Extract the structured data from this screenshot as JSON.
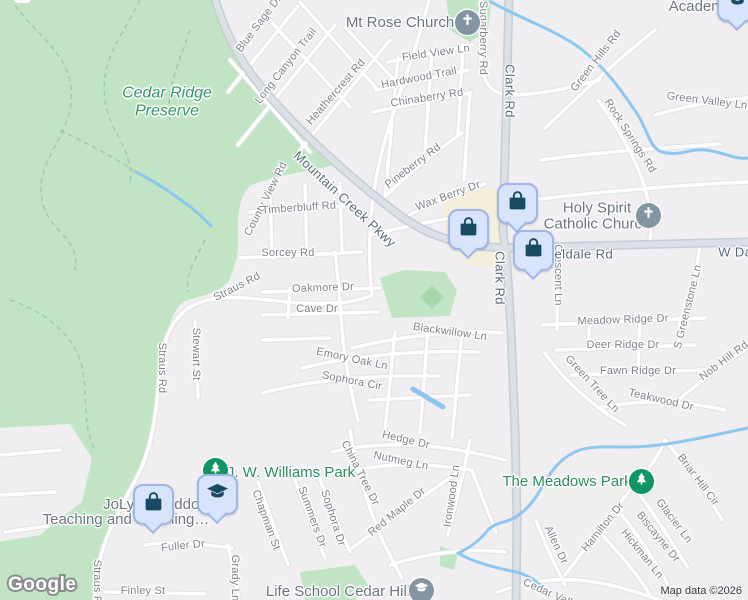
{
  "attribution": {
    "logo_text": "Google",
    "map_data_text": "Map data ©2026"
  },
  "colors": {
    "background": "#f0eef1",
    "park_green": "#c1e5c4",
    "field_green": "#a6d7a8",
    "water_blue": "#8cc7f0",
    "commercial_beige": "#f4eeda",
    "road_minor_fill": "#ffffff",
    "road_minor_casing": "#e3e0e4",
    "road_major_fill": "#dbe0e7",
    "road_major_casing": "#c6ccd4",
    "pin_blue_bg": "#d7e4fb",
    "pin_glyph_navy": "#174b63",
    "poi_pin_gray": "#8494a3",
    "park_pin_green": "#0f9463",
    "street_label": "#7e8389",
    "major_road_label": "#586a78",
    "poi_label": "#6c757d",
    "park_label": "#2d8c5f"
  },
  "map": {
    "labels": [
      {
        "text": "Blue Sage Dr",
        "x": 259,
        "y": 24,
        "rot": -53,
        "kind": "street"
      },
      {
        "text": "Long Canyon Trail",
        "x": 286,
        "y": 66,
        "rot": -52,
        "kind": "street"
      },
      {
        "text": "Heathercrest Rd",
        "x": 336,
        "y": 92,
        "rot": -49,
        "kind": "street"
      },
      {
        "text": "Sugarberry Rd",
        "x": 483,
        "y": 38,
        "rot": 90,
        "kind": "street"
      },
      {
        "text": "Field View Ln",
        "x": 436,
        "y": 53,
        "rot": -8,
        "kind": "street"
      },
      {
        "text": "Hardwood Trail",
        "x": 419,
        "y": 78,
        "rot": -11,
        "kind": "street"
      },
      {
        "text": "Chinaberry Rd",
        "x": 427,
        "y": 98,
        "rot": -9,
        "kind": "street"
      },
      {
        "text": "Green Hills Rd",
        "x": 596,
        "y": 61,
        "rot": -52,
        "kind": "street"
      },
      {
        "text": "Green Valley Ln",
        "x": 707,
        "y": 101,
        "rot": 7,
        "kind": "street"
      },
      {
        "text": "Rock Springs Rd",
        "x": 630,
        "y": 136,
        "rot": 57,
        "kind": "street"
      },
      {
        "text": "Pineberry Rd",
        "x": 413,
        "y": 166,
        "rot": -37,
        "kind": "street"
      },
      {
        "text": "Wax Berry Dr",
        "x": 448,
        "y": 196,
        "rot": -20,
        "kind": "street"
      },
      {
        "text": "County View Rd",
        "x": 266,
        "y": 199,
        "rot": -63,
        "kind": "street"
      },
      {
        "text": "Timberbluff Rd",
        "x": 299,
        "y": 208,
        "rot": -4,
        "kind": "street"
      },
      {
        "text": "Sorcey Rd",
        "x": 288,
        "y": 253,
        "rot": 0,
        "kind": "street"
      },
      {
        "text": "Straus Rd",
        "x": 237,
        "y": 287,
        "rot": -27,
        "kind": "street"
      },
      {
        "text": "Oakmore Dr",
        "x": 323,
        "y": 288,
        "rot": -2,
        "kind": "street"
      },
      {
        "text": "Cave Dr",
        "x": 317,
        "y": 309,
        "rot": 0,
        "kind": "street"
      },
      {
        "text": "Crescent Ln",
        "x": 558,
        "y": 275,
        "rot": 90,
        "kind": "street"
      },
      {
        "text": "Blackwillow Ln",
        "x": 450,
        "y": 332,
        "rot": 8,
        "kind": "street"
      },
      {
        "text": "Meadow Ridge Dr",
        "x": 623,
        "y": 320,
        "rot": -2,
        "kind": "street"
      },
      {
        "text": "Deer Ridge Dr",
        "x": 623,
        "y": 345,
        "rot": 0,
        "kind": "street"
      },
      {
        "text": "S Greenstone Ln",
        "x": 688,
        "y": 307,
        "rot": -76,
        "kind": "street"
      },
      {
        "text": "Straus Rd",
        "x": 162,
        "y": 368,
        "rot": 90,
        "kind": "street"
      },
      {
        "text": "Stewart St",
        "x": 196,
        "y": 354,
        "rot": 90,
        "kind": "street"
      },
      {
        "text": "Fawn Ridge Dr",
        "x": 638,
        "y": 371,
        "rot": 0,
        "kind": "street"
      },
      {
        "text": "Emory Oak Ln",
        "x": 352,
        "y": 359,
        "rot": 12,
        "kind": "street"
      },
      {
        "text": "Green Tree Ln",
        "x": 592,
        "y": 384,
        "rot": 47,
        "kind": "street"
      },
      {
        "text": "Sophora Cir",
        "x": 352,
        "y": 381,
        "rot": 11,
        "kind": "street"
      },
      {
        "text": "Teakwood Dr",
        "x": 661,
        "y": 400,
        "rot": 13,
        "kind": "street"
      },
      {
        "text": "Nob Hill Rd",
        "x": 724,
        "y": 361,
        "rot": -37,
        "kind": "street"
      },
      {
        "text": "Hedge Dr",
        "x": 406,
        "y": 440,
        "rot": 13,
        "kind": "street"
      },
      {
        "text": "Nutmeg Ln",
        "x": 401,
        "y": 461,
        "rot": 12,
        "kind": "street"
      },
      {
        "text": "China Tree Dr",
        "x": 360,
        "y": 473,
        "rot": 63,
        "kind": "street"
      },
      {
        "text": "Ironwood Ln",
        "x": 452,
        "y": 496,
        "rot": -82,
        "kind": "street"
      },
      {
        "text": "Red Maple Dr",
        "x": 397,
        "y": 512,
        "rot": -39,
        "kind": "street"
      },
      {
        "text": "Briar Hill Cir",
        "x": 698,
        "y": 480,
        "rot": 53,
        "kind": "street"
      },
      {
        "text": "Chapman St",
        "x": 266,
        "y": 520,
        "rot": 70,
        "kind": "street"
      },
      {
        "text": "Summers Dr",
        "x": 312,
        "y": 517,
        "rot": 70,
        "kind": "street"
      },
      {
        "text": "Sophora Dr",
        "x": 333,
        "y": 518,
        "rot": 72,
        "kind": "street"
      },
      {
        "text": "Hamilton Dr",
        "x": 603,
        "y": 527,
        "rot": -51,
        "kind": "street"
      },
      {
        "text": "Glacier Ln",
        "x": 674,
        "y": 521,
        "rot": 53,
        "kind": "street"
      },
      {
        "text": "Biscayne Dr",
        "x": 658,
        "y": 537,
        "rot": 51,
        "kind": "street"
      },
      {
        "text": "Allen Dr",
        "x": 556,
        "y": 545,
        "rot": 65,
        "kind": "street"
      },
      {
        "text": "Hickman Ln",
        "x": 642,
        "y": 554,
        "rot": 51,
        "kind": "street"
      },
      {
        "text": "Fuller Dr",
        "x": 183,
        "y": 546,
        "rot": -6,
        "kind": "street"
      },
      {
        "text": "Grady Ln",
        "x": 235,
        "y": 578,
        "rot": 90,
        "kind": "street"
      },
      {
        "text": "Finley St",
        "x": 143,
        "y": 591,
        "rot": 0,
        "kind": "street"
      },
      {
        "text": "Straus Rd",
        "x": 97,
        "y": 585,
        "rot": 90,
        "kind": "street"
      },
      {
        "text": "Cedar Valley",
        "x": 553,
        "y": 595,
        "rot": 24,
        "kind": "street"
      },
      {
        "text": "Clark Rd",
        "x": 510,
        "y": 91,
        "rot": 90,
        "kind": "major"
      },
      {
        "text": "Mountain Creek Pkwy",
        "x": 345,
        "y": 199,
        "rot": 43,
        "kind": "major"
      },
      {
        "text": "Clark Rd",
        "x": 500,
        "y": 278,
        "rot": 90,
        "kind": "major"
      },
      {
        "text": "Fieldale Rd",
        "x": 578,
        "y": 254,
        "rot": 0,
        "kind": "major"
      },
      {
        "text": "W Danieldale Rd",
        "x": 770,
        "y": 252,
        "rot": 0,
        "kind": "major"
      },
      {
        "text": "Mt Rose Church",
        "x": 400,
        "y": 23,
        "rot": 0,
        "kind": "poi"
      },
      {
        "text": "Holy Spirit\nCatholic Church",
        "x": 597,
        "y": 216,
        "rot": 0,
        "kind": "poi"
      },
      {
        "text": "Academy",
        "x": 700,
        "y": 7,
        "rot": 0,
        "kind": "poi"
      },
      {
        "text": "JoLynn Haddox",
        "x": 155,
        "y": 505,
        "rot": 0,
        "kind": "poi"
      },
      {
        "text": "Teaching and Learning…",
        "x": 126,
        "y": 520,
        "rot": 0,
        "kind": "poi"
      },
      {
        "text": "Life School Cedar Hill",
        "x": 338,
        "y": 592,
        "rot": 0,
        "kind": "poi"
      },
      {
        "text": "Cedar Ridge\nPreserve",
        "x": 167,
        "y": 102,
        "rot": 0,
        "kind": "preserve"
      },
      {
        "text": "J. W. Williams Park",
        "x": 291,
        "y": 473,
        "rot": 0,
        "kind": "park"
      },
      {
        "text": "The Meadows Park",
        "x": 567,
        "y": 482,
        "rot": 0,
        "kind": "park"
      }
    ],
    "markers": [
      {
        "type": "white-remnant",
        "icon": "clipped-pin",
        "x": 22,
        "y": -6
      },
      {
        "type": "park",
        "icon": "tree-icon",
        "x": 215,
        "y": 470
      },
      {
        "type": "park",
        "icon": "tree-icon",
        "x": 641,
        "y": 481
      },
      {
        "type": "church",
        "icon": "cross-icon",
        "x": 467,
        "y": 22
      },
      {
        "type": "church",
        "icon": "cross-icon",
        "x": 648,
        "y": 215
      },
      {
        "type": "school",
        "icon": "graduation-cap-icon",
        "x": 421,
        "y": 590
      },
      {
        "type": "shopping",
        "icon": "shopping-bag-icon",
        "x": 468,
        "y": 229
      },
      {
        "type": "shopping",
        "icon": "shopping-bag-icon",
        "x": 517,
        "y": 203
      },
      {
        "type": "shopping",
        "icon": "shopping-bag-icon",
        "x": 533,
        "y": 250
      },
      {
        "type": "shopping",
        "icon": "shopping-bag-icon",
        "x": 153,
        "y": 504
      },
      {
        "type": "education",
        "icon": "graduation-cap-icon",
        "x": 217,
        "y": 494
      },
      {
        "type": "education",
        "icon": "graduation-cap-icon",
        "x": 737,
        "y": 1
      }
    ]
  }
}
